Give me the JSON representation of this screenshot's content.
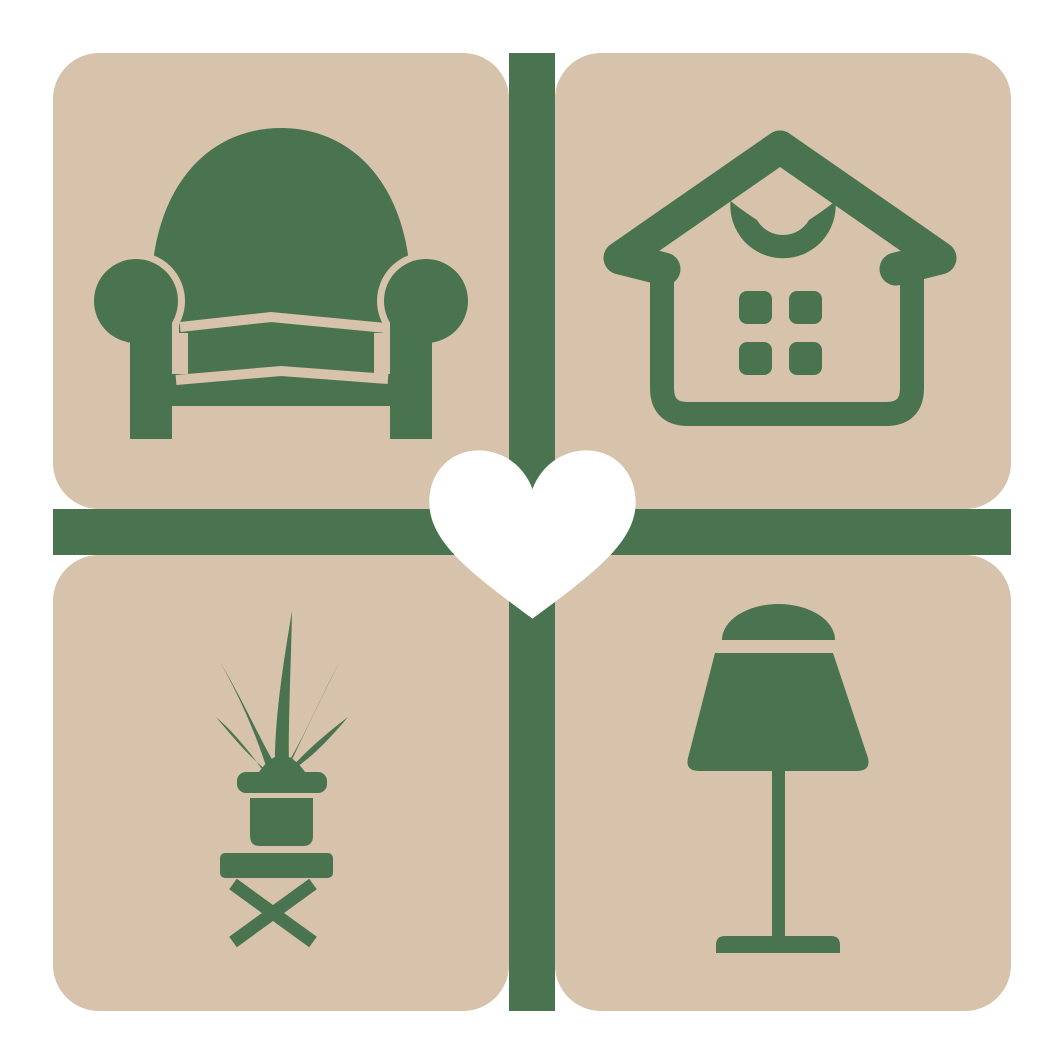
{
  "meta": {
    "type": "logo-graphic",
    "description": "Home and furniture brand mark: four beige rounded tiles in a 2x2 grid separated by a dark green cross, each tile holding a green furnishing glyph, with a white heart at the center"
  },
  "colors": {
    "background": "#ffffff",
    "tile": "#d7c2ac",
    "green": "#4a744f",
    "heart": "#ffffff"
  },
  "tiles": [
    {
      "position": "top-left",
      "icon": "armchair-icon",
      "label": "Armchair"
    },
    {
      "position": "top-right",
      "icon": "house-icon",
      "label": "House"
    },
    {
      "position": "bottom-left",
      "icon": "potted-plant-stool-icon",
      "label": "Potted plant on stool"
    },
    {
      "position": "bottom-right",
      "icon": "table-lamp-icon",
      "label": "Table lamp"
    }
  ],
  "center": {
    "icon": "heart-icon",
    "label": "Heart"
  },
  "dividers": {
    "vertical": "divider-vertical",
    "horizontal": "divider-horizontal"
  }
}
